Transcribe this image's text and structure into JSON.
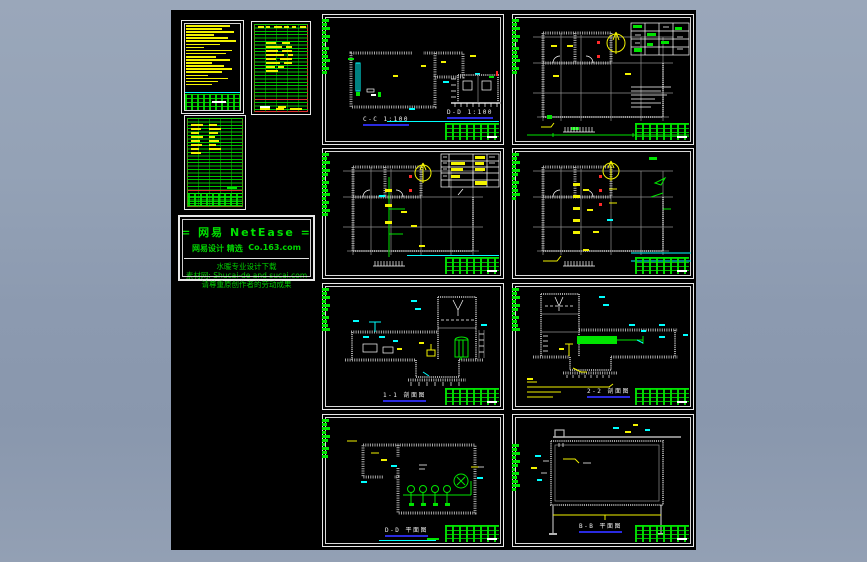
{
  "palette": {
    "workspace_bg": "#919fb3",
    "canvas_bg": "#000000",
    "wall_gray": "#a9a9a9",
    "cad_green": "#00e400",
    "cad_yellow": "#f2f200",
    "cad_cyan": "#00ffff",
    "cad_red": "#ff2a2a",
    "caption_underline_blue": "#2a2ae0",
    "frame_white": "#e9e9e9"
  },
  "watermark": {
    "line1": "= 网易 NetEase =",
    "line2_left": "网易设计 精选",
    "line2_right": "Co.163.com",
    "line3": "水暖专业设计下载",
    "line4": "素材网: Shucai-de and sucai.com",
    "line5": "请尊重原创作者的劳动成果"
  },
  "drawings": {
    "d1": {
      "caption": "C-C 1:100",
      "caption2": "D-D 1:100"
    },
    "d2": {
      "caption": ""
    },
    "d3": {
      "caption": ""
    },
    "d4": {
      "caption": ""
    },
    "d5": {
      "caption": "1-1 剖面图"
    },
    "d6": {
      "caption": "2-2 剖面图"
    },
    "d7": {
      "caption": "D-D 平面图"
    },
    "d8": {
      "caption": "B-B 平面图"
    }
  }
}
